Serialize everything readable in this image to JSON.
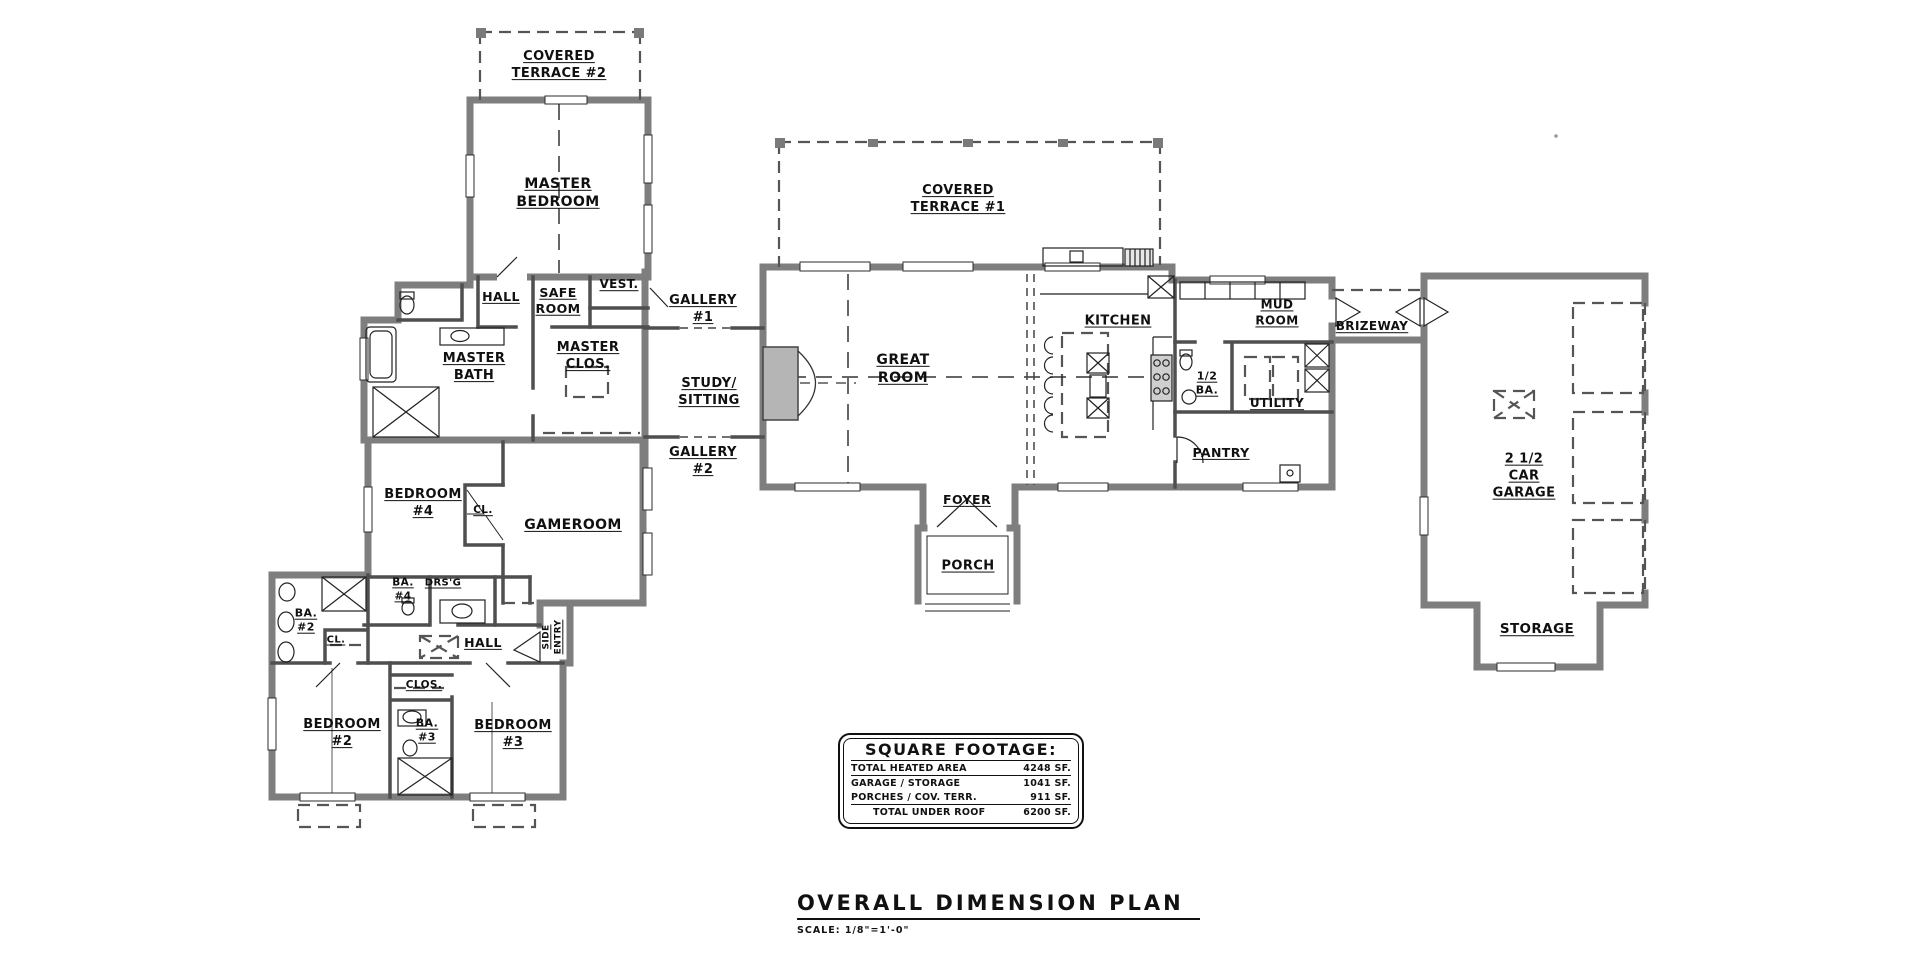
{
  "sheet": {
    "title": "OVERALL DIMENSION PLAN",
    "scale": "SCALE:  1/8\"=1'-0\""
  },
  "square_footage": {
    "title": "SQUARE FOOTAGE:",
    "rows": [
      {
        "label": "TOTAL HEATED AREA",
        "value": "4248 SF."
      },
      {
        "label": "GARAGE / STORAGE",
        "value": "1041 SF."
      },
      {
        "label": "PORCHES / COV. TERR.",
        "value": "911 SF."
      },
      {
        "label": "TOTAL UNDER ROOF",
        "value": "6200 SF."
      }
    ]
  },
  "rooms": {
    "covered_terrace_2": "COVERED\nTERRACE #2",
    "master_bedroom": "MASTER\nBEDROOM",
    "hall_master": "HALL",
    "safe_room": "SAFE\nROOM",
    "vest": "VEST.",
    "master_bath": "MASTER\nBATH",
    "master_clos": "MASTER\nCLOS.",
    "gallery_1": "GALLERY\n#1",
    "study_sitting": "STUDY/\nSITTING",
    "gallery_2": "GALLERY\n#2",
    "covered_terrace_1": "COVERED\nTERRACE #1",
    "great_room": "GREAT\nROOM",
    "kitchen": "KITCHEN",
    "mud_room": "MUD\nROOM",
    "brizeway": "BRIZEWAY",
    "half_ba": "1/2\nBA.",
    "utility": "UTILITY",
    "pantry": "PANTRY",
    "foyer": "FOYER",
    "porch": "PORCH",
    "garage": "2 1/2\nCAR\nGARAGE",
    "storage": "STORAGE",
    "bedroom_4": "BEDROOM\n#4",
    "cl_bedroom_4": "CL.",
    "gameroom": "GAMEROOM",
    "ba_4": "BA.\n#4",
    "drsg": "DRS'G",
    "ba_2": "BA.\n#2",
    "cl_ba_2": "CL.",
    "hall_bedrooms": "HALL",
    "side_entry": "SIDE\nENTRY",
    "clos": "CLOS.",
    "bedroom_2": "BEDROOM\n#2",
    "ba_3": "BA.\n#3",
    "bedroom_3": "BEDROOM\n#3"
  }
}
